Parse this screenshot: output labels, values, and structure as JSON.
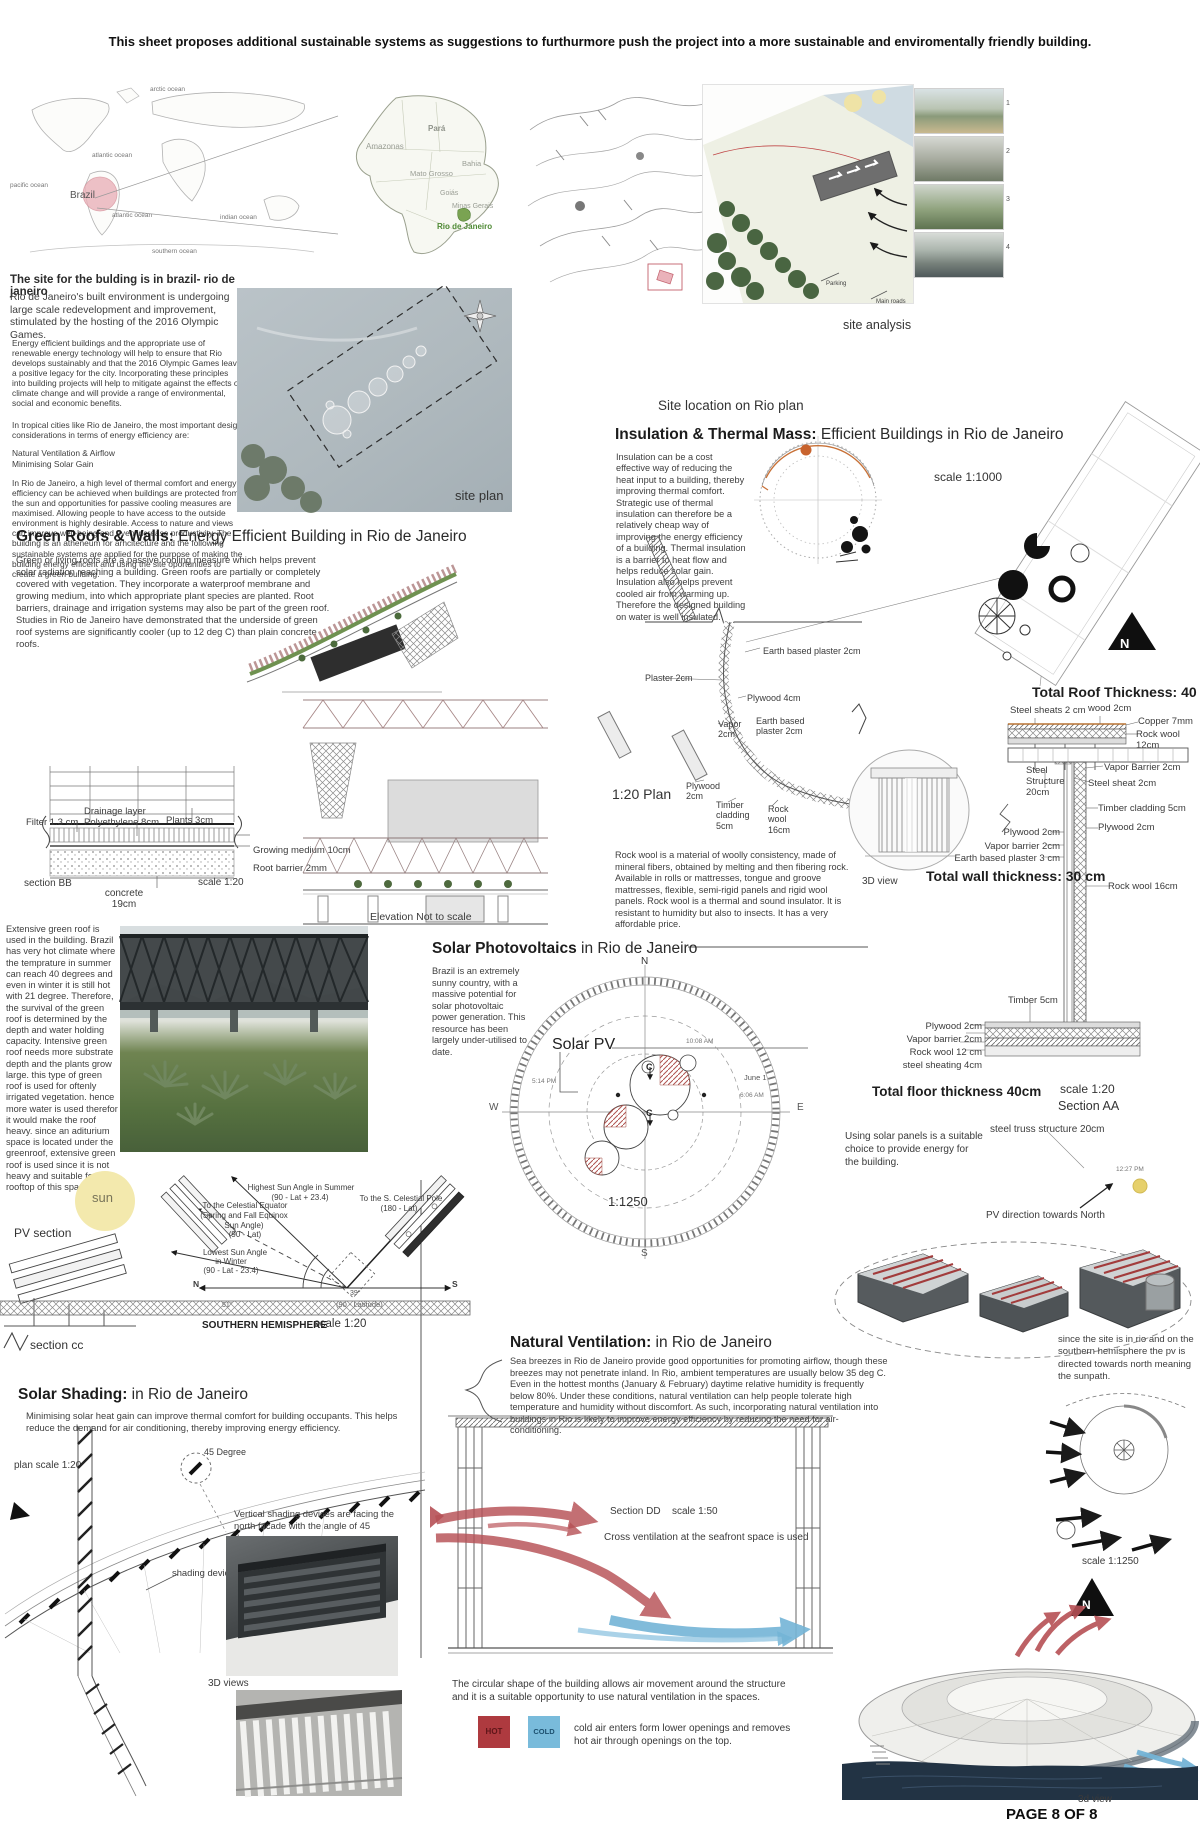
{
  "header": {
    "title": "This sheet proposes additional sustainable systems as suggestions to furthurmore push the project into a more sustainable and enviromentally friendly building."
  },
  "world_map": {
    "oceans": [
      "arctic ocean",
      "atlantic ocean",
      "pacific ocean",
      "atlantic ocean",
      "indian ocean",
      "southern ocean"
    ],
    "brazil_label": "Brazil"
  },
  "brazil_map": {
    "states": [
      "Pará",
      "Amazonas",
      "Mato Grosso",
      "Bahia",
      "Goiás",
      "Minas Gerais"
    ],
    "rio_label": "Rio de Janeiro"
  },
  "rio_plan": {
    "caption": "Site location on Rio plan"
  },
  "site_analysis": {
    "caption": "site analysis",
    "notes": [
      "Parking",
      "Main roads"
    ],
    "photo_numbers": [
      "1",
      "2",
      "3",
      "4"
    ]
  },
  "intro": {
    "heading": "The site for the bulding is in brazil- rio de janeiro",
    "p1": "Rio de Janeiro's built environment is undergoing large scale redevelopment and improvement, stimulated by the hosting of the 2016 Olympic Games.",
    "p2": "Energy efficient buildings and the appropriate use of renewable energy technology will help to ensure that Rio develops sustainably and that the 2016 Olympic Games leave a positive legacy for the city. Incorporating these principles into building projects will help to mitigate against the effects of climate change and will provide a range of environmental, social and economic benefits.",
    "p3": "In tropical cities like Rio de Janeiro, the most important design considerations in terms of energy efficiency are:",
    "p4a": "Natural Ventilation & Airflow",
    "p4b": "Minimising Solar Gain",
    "p5": "In Rio de Janeiro, a high level of thermal comfort and energy efficiency can be achieved when buildings are protected from the sun and opportunities for passive cooling measures are maximised. Allowing people to have access to the outside environment is highly desirable. Access to nature and views can improve well-being and even increase productivity. The building is an atheneum for arhcitecture and the following sustainable systems are applied for the purpose of making the building energy efficent and using the site oportunities to create a green building."
  },
  "site_plan": {
    "caption": "site plan"
  },
  "insulation": {
    "title_bold": "Insulation & Thermal Mass:",
    "title_rest": " Efficient Buildings in Rio de Janeiro",
    "body": "Insulation can be a cost effective way of reducing the heat input to a building, thereby improving thermal comfort. Strategic use of thermal insulation can therefore be a relatively cheap way of improving the energy efficiency of a building. Thermal insulation is a barrier to heat flow and helps reduce solar gain. Insulation also helps prevent cooled air from warming up. Therefore the designed building on water is well insulated.",
    "scale": "scale 1:1000",
    "north": "N"
  },
  "wall_plan": {
    "scale_label": "1:20 Plan",
    "earth_plaster_top": "Earth based plaster 2cm",
    "plaster": "Plaster 2cm",
    "plywood4": "Plywood 4cm",
    "vapor": "Vapor 2cm",
    "earth_plaster_mid": "Earth based plaster 2cm",
    "plywood2": "Plywood 2cm",
    "timber_cladding": "Timber cladding 5cm",
    "rock_wool": "Rock wool 16cm"
  },
  "green_roofs": {
    "title_bold": "Green Roofs & Walls:",
    "title_rest": " Energy Efficient Building in Rio de Janeiro",
    "body": "Green or living roofs are a passive cooling measure which helps prevent solar radiation reaching a building. Green roofs are partially or completely covered with vegetation. They incorporate a waterproof membrane and growing medium, into which appropriate plant species are planted. Root barriers, drainage and irrigation systems may also be part of the green roof. Studies in Rio de Janeiro have demonstrated that the underside of green roof systems are significantly cooler (up to 12 deg C) than plain concrete roofs.",
    "extensive": "Extensive green roof is used in the building. Brazil has very hot climate where the temprature in summer can reach 40 degrees and even in winter it is still hot with 21 degree. Therefore, the survival of the green roof is determined by the depth and water holding capacity. Intensive green roof needs more substrate depth and the plants grow large. this type of green roof is used for oftenly irrigated vegetation. hence more water is used therefor it would make the roof heavy. since an aditurium space is located under the greenroof, extensive green roof is used since it is not heavy and suitable for the rooftop of this space.",
    "elevation_caption": "Elevation Not to scale"
  },
  "roof_layers": {
    "filter": "Filter 1.3 cm",
    "drainage": "Drainage layer Polyethylene 8cm",
    "plants": "Plants 3cm",
    "growing": "Growing medium 10cm",
    "root": "Root barrier 2mm",
    "section": "section BB",
    "concrete": "concrete 19cm",
    "scale": "scale 1:20"
  },
  "roof_detail": {
    "title": "Total Roof Thickness: 40 cm",
    "steel_sheats": "Steel sheats 2 cm",
    "wood": "wood 2cm",
    "copper": "Copper 7mm",
    "rock_wool": "Rock wool 12cm"
  },
  "wall_detail": {
    "title": "Total wall thickness: 30 cm",
    "steel_structure": "Steel Structure 20cm",
    "vapor_barrier_top": "Vapor Barrier 2cm",
    "steel_sheat": "Steel sheat 2cm",
    "timber_cladding": "Timber cladding 5cm",
    "plywood_right": "Plywood 2cm",
    "plywood_left": "Plywood 2cm",
    "vapor_barrier_left": "Vapor barrier 2cm",
    "earth_plaster": "Earth based plaster 3 cm",
    "rock_wool": "Rock wool 16cm",
    "view3d": "3D view"
  },
  "floor_detail": {
    "title": "Total floor thickness 40cm",
    "timber": "Timber 5cm",
    "plywood": "Plywood 2cm",
    "vapor_barrier": "Vapor barrier 2cm",
    "rock_wool": "Rock wool 12 cm",
    "steel_sheating": "steel sheating 4cm",
    "scale": "scale 1:20",
    "section": "Section AA"
  },
  "rock_wool_note": "Rock wool is a material of woolly consistency, made of mineral fibers, obtained by melting and then fibering rock. Available in rolls or mattresses, tongue and groove mattresses, flexible, semi-rigid panels and rigid wool panels. Rock wool is a thermal and sound insulator. It is resistant to humidity but also to insects. It has a very affordable price.",
  "solar_pv": {
    "title_bold": "Solar Photovoltaics",
    "title_rest": " in Rio de Janeiro",
    "body": "Brazil is an extremely sunny country, with a massive potential for solar photovoltaic power generation. This resource has been largely under-utilised to date.",
    "label": "Solar PV",
    "scale": "1:1250",
    "n": "N",
    "s": "S",
    "e": "E",
    "w": "W",
    "t1": "10:08 AM",
    "t2": "June 1",
    "t3": "6:06 AM",
    "t4": "5:14 PM",
    "c1": "C",
    "c2": "C",
    "panel_note": "Using solar panels is a suitable choice to provide energy for the building.",
    "truss": "steel truss structure 20cm",
    "noon": "12:27 PM",
    "direction": "PV direction towards North",
    "site_note": "since the site is in rio and on the southern hemisphere the pv is directed towards north meaning the sunpath."
  },
  "pv_section": {
    "sun": "sun",
    "caption": "PV section",
    "highest1": "Highest Sun Angle in Summer",
    "highest2": "(90 - Lat + 23.4)",
    "pole1": "To the S. Celestial Pole",
    "pole2": "(180 - Lat)",
    "equator1": "To the Celestial Equator",
    "equator2": "(Spring and Fall Equinox",
    "equator3": "Sun Angle)",
    "equator4": "(90 - Lat)",
    "lowest1": "Lowest Sun Angle",
    "lowest2": "in Winter",
    "lowest3": "(90 - Lat - 23.4)",
    "n": "N",
    "s": "S",
    "deg1": "51°",
    "deg2": "39°",
    "lat90": "(90 - Latitude)",
    "hemisphere": "SOUTHERN HEMISPHERE",
    "scale": "scale 1:20",
    "section_cc": "section cc"
  },
  "ventilation": {
    "title_bold": "Natural Ventilation:",
    "title_rest": " in Rio de Janeiro",
    "body": "Sea breezes in Rio de Janeiro provide good opportunities for promoting airflow, though these breezes may not penetrate inland. In Rio, ambient temperatures are usually below 35 deg C. Even in the hottest months (January & February) daytime relative humidity is frequently below 80%. Under these conditions, natural ventilation can help people tolerate high temperature and humidity without discomfort. As such, incorporating natural ventilation into buildings in Rio is likely to improve energy efficiency by reducing the need for air-conditioning.",
    "section_dd": "Section DD",
    "scale_dd": "scale 1:50",
    "cross": "Cross ventilation at the seafront space is used",
    "circular": "The circular shape of the building allows air movement around the structure and it is a suitable opportunity to use natural ventilation in the spaces.",
    "hot": "HOT",
    "cold": "COLD",
    "cold_note": "cold air enters form lower openings and removes hot air through openings on the top.",
    "scale_right": "scale  1:1250",
    "view3d": "3d view",
    "n": "N"
  },
  "shading": {
    "title_bold": "Solar Shading:",
    "title_rest": " in Rio de Janeiro",
    "body": "Minimising solar heat gain can improve thermal comfort for building occupants. This helps reduce the demand for air conditioning, thereby improving energy efficiency.",
    "plan_scale": "plan scale 1:20",
    "degree": "45 Degree",
    "note": "Vertical shading devices are facing the north facade with the angle of 45 degrees",
    "devices_label": "shading devices",
    "views3d": "3D views"
  },
  "footer": {
    "page_number": "PAGE 8 OF 8"
  },
  "colors": {
    "accent_red": "#b65055",
    "accent_blue": "#74b4d6",
    "hot": "#ae3a3f",
    "cold": "#79bbdb",
    "sun": "#f3e9ad",
    "pink": "#e9aeb6",
    "green_text": "#4e8a34"
  }
}
